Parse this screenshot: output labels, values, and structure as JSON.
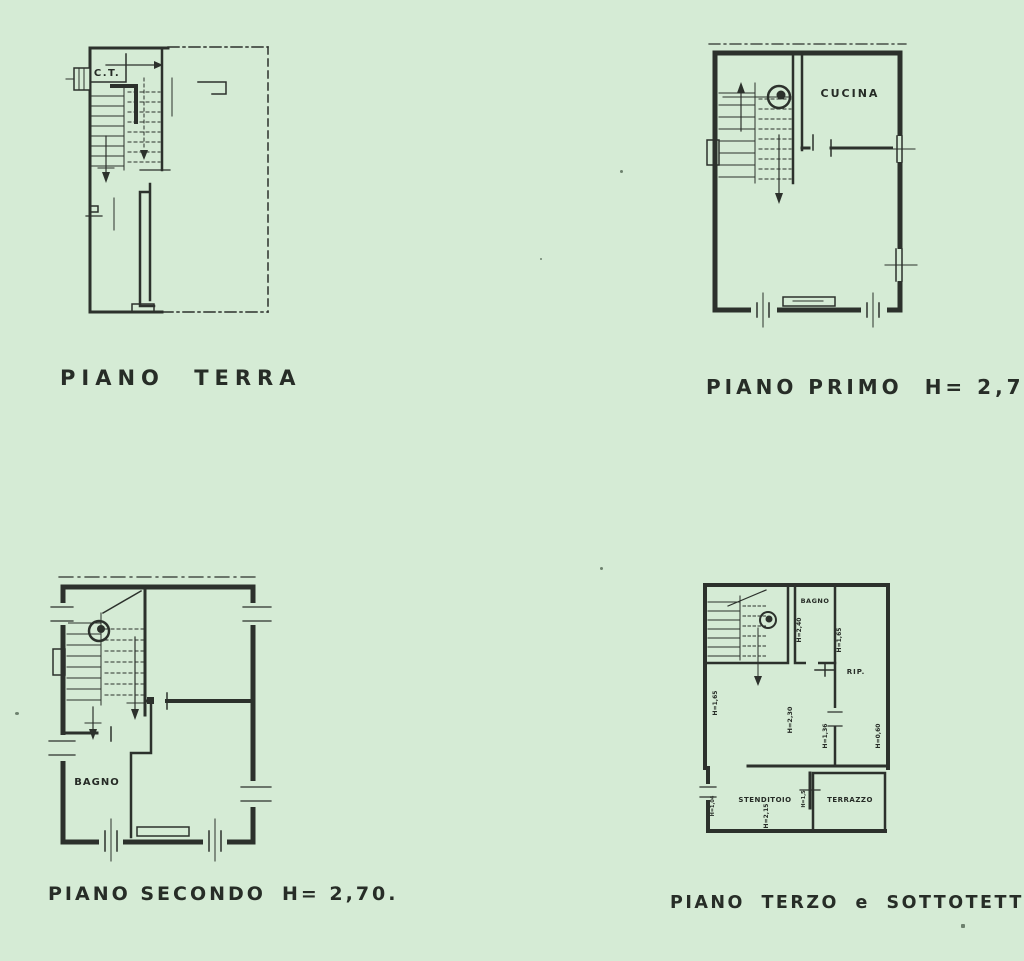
{
  "document": {
    "background_color": "#d5ebd5",
    "ink_color": "#2c312c"
  },
  "terra": {
    "caption": "PIANO TERRA",
    "room_ct": "C.T."
  },
  "primo": {
    "caption": "PIANO PRIMO",
    "height": "H= 2,75",
    "room_cucina": "CUCINA"
  },
  "secondo": {
    "caption": "PIANO SECONDO",
    "height": "H= 2,70.",
    "room_bagno": "BAGNO"
  },
  "terzo": {
    "caption": "PIANO TERZO e SOTTOTETTO",
    "room_bagno": "BAGNO",
    "room_rip": "RIP.",
    "room_stenditoio": "STENDITOIO",
    "room_terrazzo": "TERRAZZO",
    "h_bagno": "H=2,40",
    "h_bagno_wall": "H=1,65",
    "h_left_wall": "H=1,65",
    "h_center": "H=2,30",
    "h_mid_wall": "H=1,36",
    "h_right_wall": "H=0,60",
    "h_stenditoio": "H=2,15",
    "h_terrazzo_door": "H=1,5",
    "h_entry": "H=1,04"
  }
}
